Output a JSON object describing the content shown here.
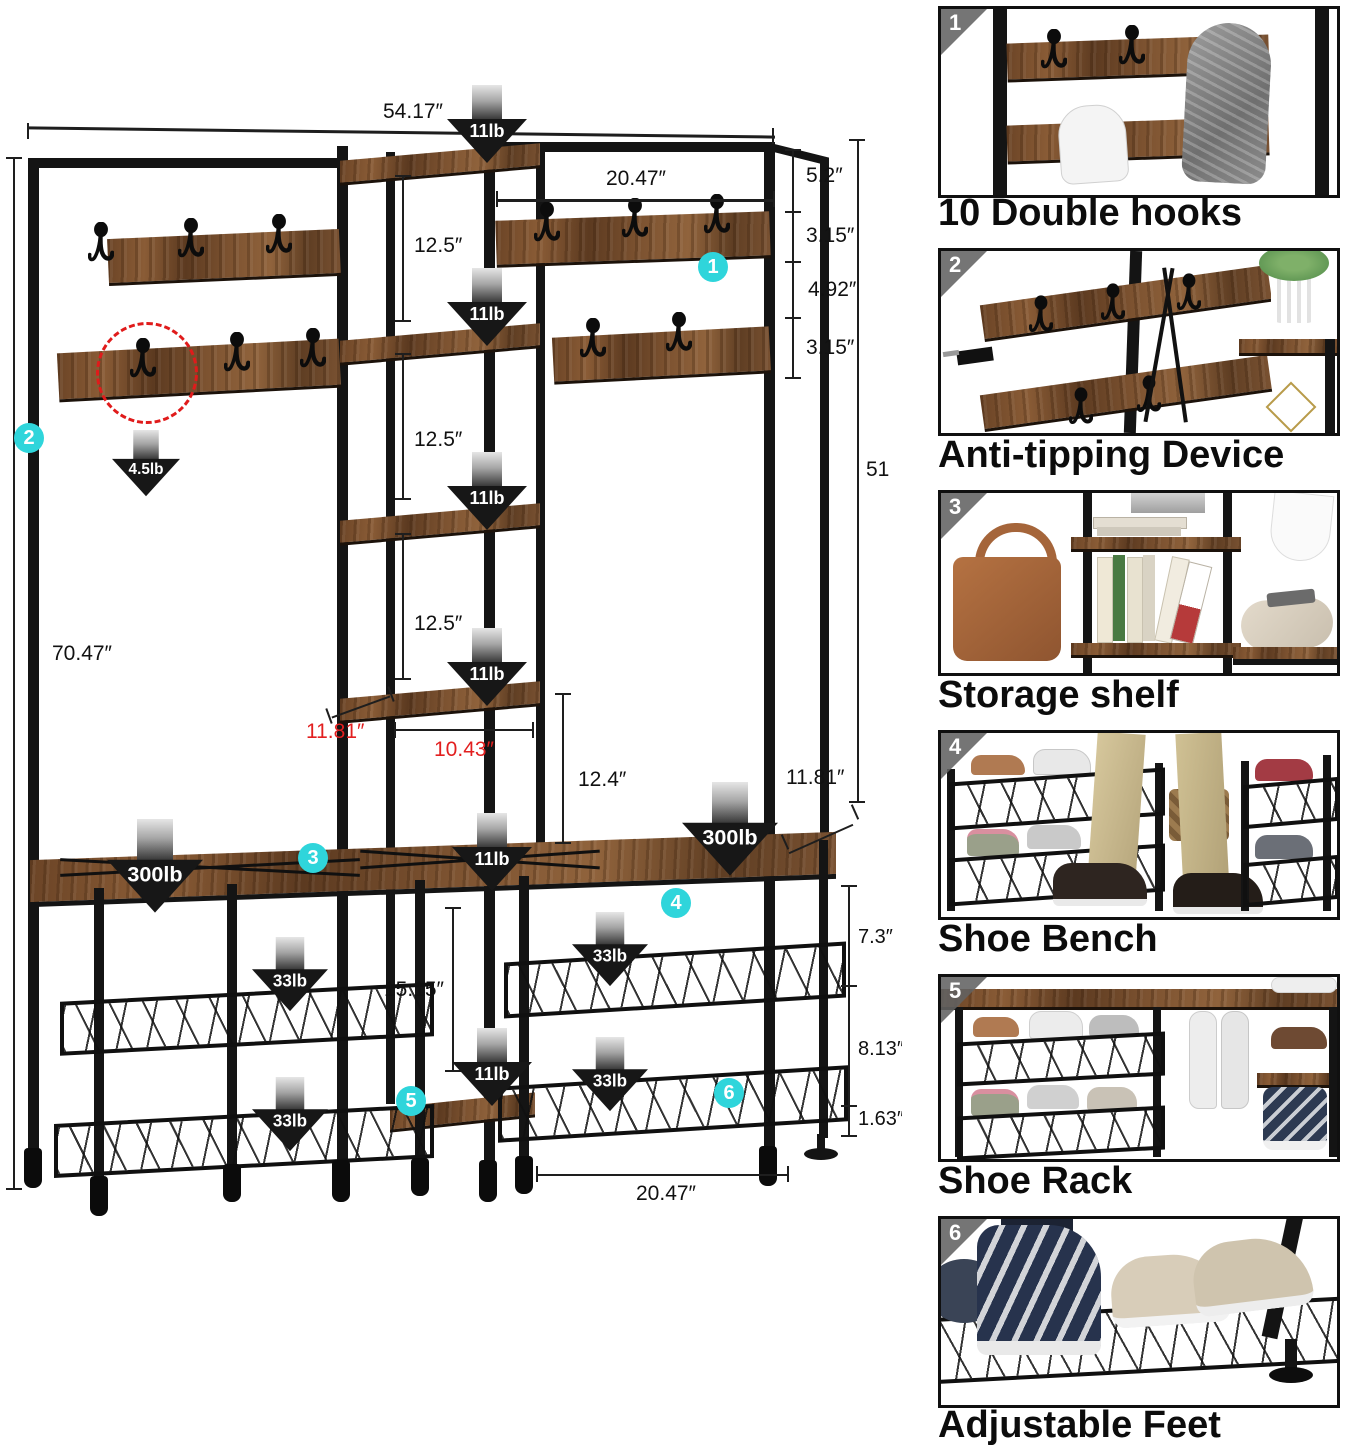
{
  "diagram": {
    "dims": {
      "overall_width": "54.17″",
      "right_section_width": "20.47″",
      "top_gap": "5.2″",
      "hook_board_a": "3.15″",
      "hook_gap": "4.92″",
      "hook_board_b": "3.15″",
      "right_height": "51",
      "shelf_gap_1": "12.5″",
      "shelf_gap_2": "12.5″",
      "shelf_gap_3": "12.5″",
      "shelf_to_bench": "12.4″",
      "tower_depth": "11.81″",
      "tower_inner_width": "10.43″",
      "bench_depth": "11.81″",
      "bench_to_bottom_shelf": "15.15″",
      "overall_height": "70.47″",
      "bench_width": "20.47″",
      "bench_seg_top": "7.3″",
      "bench_seg_mid": "8.13″",
      "bench_seg_bottom": "1.63″"
    },
    "loads": {
      "shelf": "11lb",
      "hook": "4.5lb",
      "bench": "300lb",
      "wire_shelf": "33lb"
    },
    "badges": [
      "1",
      "2",
      "3",
      "4",
      "5",
      "6"
    ]
  },
  "features": [
    {
      "num": "1",
      "caption": "10 Double hooks"
    },
    {
      "num": "2",
      "caption": "Anti-tipping Device"
    },
    {
      "num": "3",
      "caption": "Storage shelf"
    },
    {
      "num": "4",
      "caption": "Shoe Bench"
    },
    {
      "num": "5",
      "caption": "Shoe Rack"
    },
    {
      "num": "6",
      "caption": "Adjustable Feet"
    }
  ],
  "colors": {
    "accent_cyan": "#2fd5db",
    "dim_red": "#e21f1f",
    "wood": "#7a5232",
    "frame": "#141414"
  }
}
